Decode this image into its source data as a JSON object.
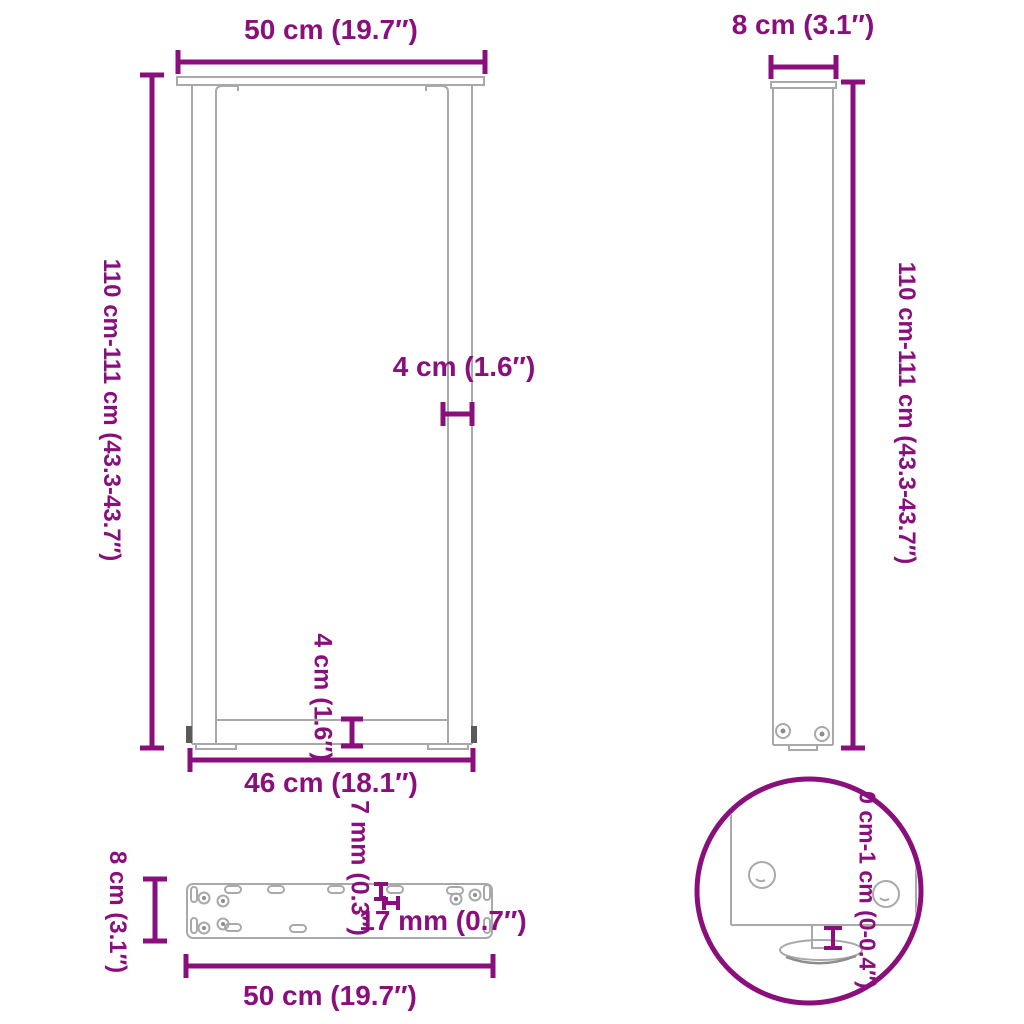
{
  "title": "Table leg dimension diagram",
  "colors": {
    "accent_purple": "#8a0f7c",
    "drawing_gray": "#a9a9a9",
    "dark_gray": "#5a5a5a",
    "background": "#ffffff"
  },
  "views": {
    "front": {
      "labels": {
        "width_top": "50 cm (19.7″)",
        "height": "110 cm-111 cm (43.3-43.7″)",
        "leg_thickness": "4 cm (1.6″)",
        "crossbar_height": "4 cm (1.6″)",
        "inner_width": "46 cm (18.1″)"
      }
    },
    "side": {
      "labels": {
        "depth_top": "8 cm (3.1″)",
        "height": "110 cm-111 cm (43.3-43.7″)"
      }
    },
    "plate_top": {
      "labels": {
        "depth": "8 cm (3.1″)",
        "slot_width": "7 mm (0.3″)",
        "slot_length": "17 mm (0.7″)",
        "width": "50 cm (19.7″)"
      }
    },
    "detail": {
      "labels": {
        "adjustable_range": "0 cm-1 cm (0-0.4″)"
      }
    }
  }
}
